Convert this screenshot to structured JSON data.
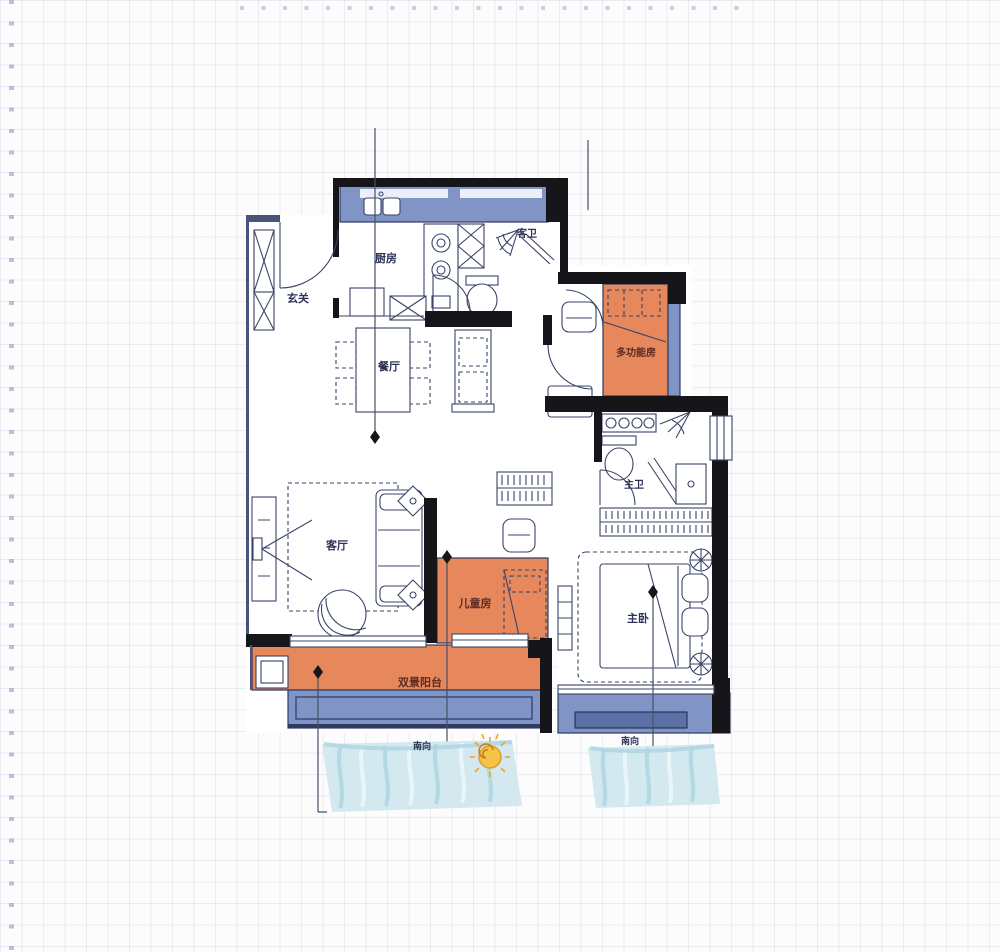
{
  "rooms": {
    "entry": {
      "label": "玄关"
    },
    "kitchen": {
      "label": "厨房"
    },
    "guest_bath": {
      "label": "客卫"
    },
    "dining": {
      "label": "餐厅"
    },
    "multi_room": {
      "label": "多功能房"
    },
    "master_bath": {
      "label": "主卫"
    },
    "living": {
      "label": "客厅"
    },
    "kids_room": {
      "label": "儿童房"
    },
    "master_bedroom": {
      "label": "主卧"
    },
    "balcony": {
      "label": "双景阳台"
    }
  },
  "orientation": {
    "south_left": "南向",
    "south_right": "南向"
  },
  "icons": {
    "sun": "sun-icon",
    "water_left": "water-view",
    "water_right": "water-view"
  },
  "colors": {
    "wall": "#16161a",
    "line": "#3a4468",
    "orange": "#e6875c",
    "blue_band": "#8095c5",
    "blue_dark": "#5b70a6",
    "water": "#d3e9ef",
    "sun": "#f3c445",
    "label": "#2c3156",
    "label_on_orange": "#5c2a22"
  }
}
